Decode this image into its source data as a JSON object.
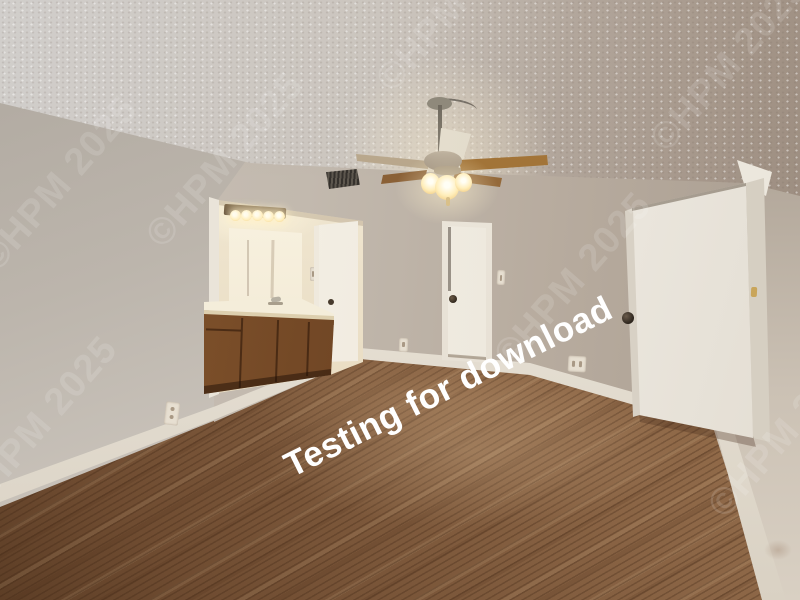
{
  "meta": {
    "type": "photograph",
    "subject": "Empty bedroom interior with bathroom vanity alcove, ceiling fan and open entry door"
  },
  "watermarks": {
    "primary": {
      "text": "Testing for download",
      "color": "#ffffff",
      "rotation_deg": -26.5,
      "style": "bold white"
    },
    "copyright": {
      "text": "©HPM 2025",
      "color": "#ffffff",
      "opacity": 0.13,
      "rotation_deg": -49,
      "count": 7
    }
  },
  "scene": {
    "room": "bedroom",
    "features": [
      "popcorn textured ceiling",
      "ceiling fan with five blades and lit three-globe light kit",
      "ceiling air vent",
      "greige walls with white baseboards",
      "brown wood-plank flooring",
      "vanity alcove with five-bulb light bar, mirror, cream countertop and oak cabinets",
      "white bathroom door",
      "closed white closet door with dark knob",
      "open white entry door with dark knob",
      "light switches and power outlets"
    ]
  },
  "palette": {
    "ceiling": "#ccc6bf",
    "walls": "#c1b8ad",
    "floor": "#8c6647",
    "trim": "#ebe6dc",
    "cabinets": "#7a4f2b",
    "doors": "#f2eee7",
    "fan_wood_blade": "#9a6e3d",
    "light_glow": "#ffeebb"
  }
}
